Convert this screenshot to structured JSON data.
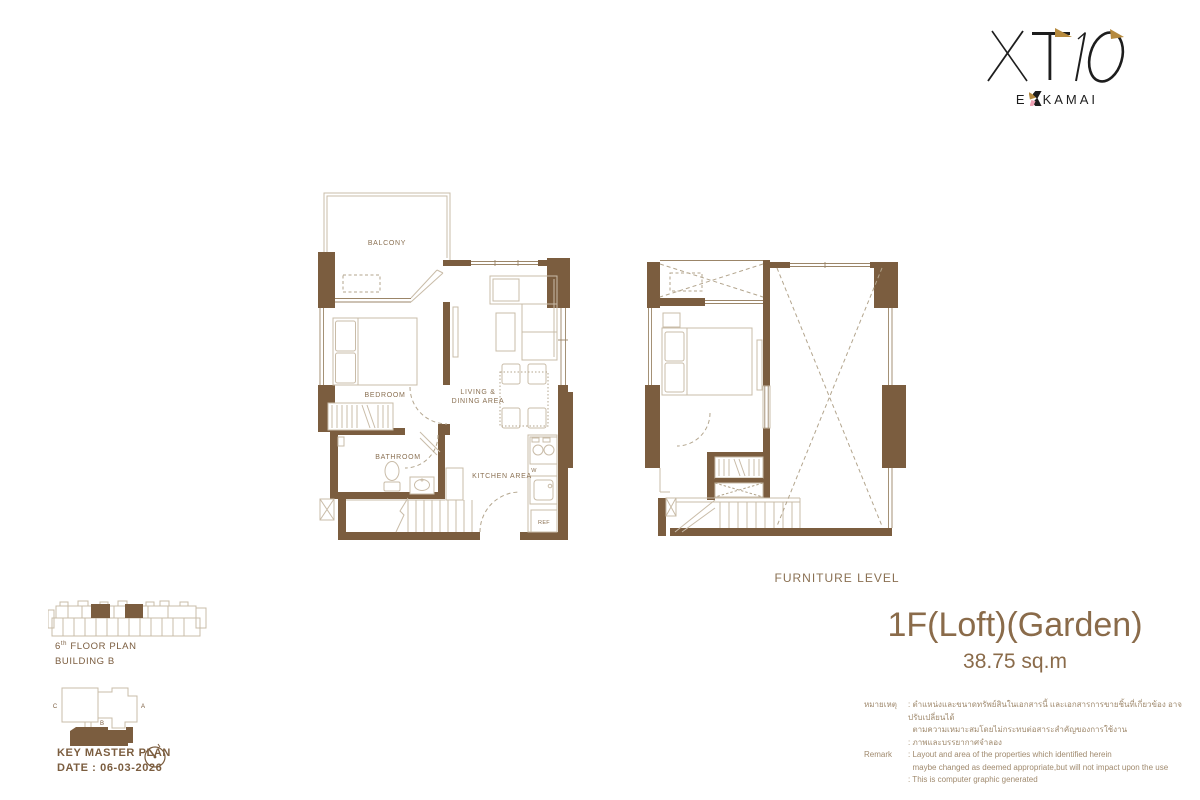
{
  "logo": {
    "brand": "XT10",
    "word_prefix": "E",
    "word_suffix": "KAMAI"
  },
  "plan_left": {
    "labels": {
      "balcony": "BALCONY",
      "bedroom": "BEDROOM",
      "living1": "LIVING &",
      "living2": "DINING AREA",
      "bathroom": "BATHROOM",
      "kitchen": "KITCHEN AREA",
      "washer": "W",
      "fridge": "REF"
    }
  },
  "plan_right": {
    "caption": "FURNITURE LEVEL"
  },
  "title_block": {
    "unit_type": "1F(Loft)(Garden)",
    "area": "38.75 sq.m"
  },
  "footer": {
    "floor_num": "6",
    "floor_sup": "th",
    "floor_rest": " FLOOR PLAN",
    "building": "BUILDING B",
    "key_master": "KEY MASTER PLAN",
    "date": "DATE : 06-03-2026",
    "key_labels": {
      "a": "A",
      "b": "B",
      "c": "C"
    }
  },
  "remark": {
    "rows": [
      {
        "label": "หมายเหตุ",
        "text": ": ตำแหน่งและขนาดทรัพย์สินในเอกสารนี้ และเอกสารการขายชิ้นที่เกี่ยวข้อง อาจปรับเปลี่ยนได้"
      },
      {
        "label": "",
        "text": "  ตามความเหมาะสมโดยไม่กระทบต่อสาระสำคัญของการใช้งาน"
      },
      {
        "label": "",
        "text": ": ภาพและบรรยากาศจำลอง"
      },
      {
        "label": "Remark",
        "text": ": Layout and area of the properties which identified herein"
      },
      {
        "label": "",
        "text": "  maybe changed as deemed appropriate,but will not impact upon the use"
      },
      {
        "label": "",
        "text": ": This is computer graphic generated"
      }
    ]
  },
  "colors": {
    "wall": "#7b5d3f",
    "line": "#c9bca8",
    "line2": "#b3a58d",
    "win": "#9b8568",
    "label": "#8a7052",
    "title": "#8a6b4a",
    "remark": "#a08a6e",
    "footer": "#7b5d3f",
    "gold": "#b68a3e",
    "pink": "#f0a3b5",
    "ink": "#1d1d1d"
  }
}
